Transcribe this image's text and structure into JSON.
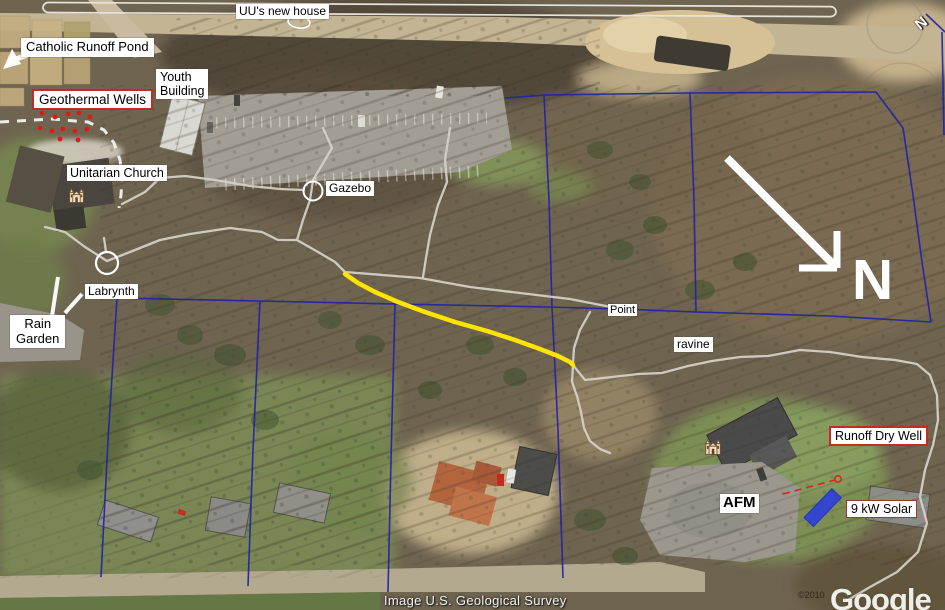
{
  "map": {
    "annotations": {
      "uu_new_house": "UU's new house",
      "catholic_runoff_pond": "Catholic Runoff Pond",
      "youth_building": "Youth\nBuilding",
      "geothermal_wells": "Geothermal Wells",
      "unitarian_church": "Unitarian Church",
      "gazebo": "Gazebo",
      "labrynth": "Labrynth",
      "rain_garden": "Rain\nGarden",
      "point": "Point",
      "ravine": "ravine",
      "runoff_dry_well": "Runoff Dry Well",
      "afm": "AFM",
      "solar": "9 kW Solar"
    },
    "compass": {
      "big_n": "N",
      "small_n": "N"
    },
    "attribution": {
      "imagery_credit": "Image U.S. Geological Survey",
      "copyright": "©2010",
      "watermark": "Google"
    },
    "icons": {
      "church_icon": "church placemark",
      "north_arrow_icon": "north arrow",
      "pond_arrow_icon": "arrow to pond",
      "rain_garden_arrow_icon": "arrows to rain garden"
    },
    "legend_colors": {
      "property_line": "#2222a6",
      "trail": "#d4d0c6",
      "highlighted_trail": "#ffe400",
      "well_marker": "#e01818",
      "dry_well_marker": "#e02020",
      "solar_panel": "#3446cf",
      "label_red_border": "#c22c24"
    }
  }
}
